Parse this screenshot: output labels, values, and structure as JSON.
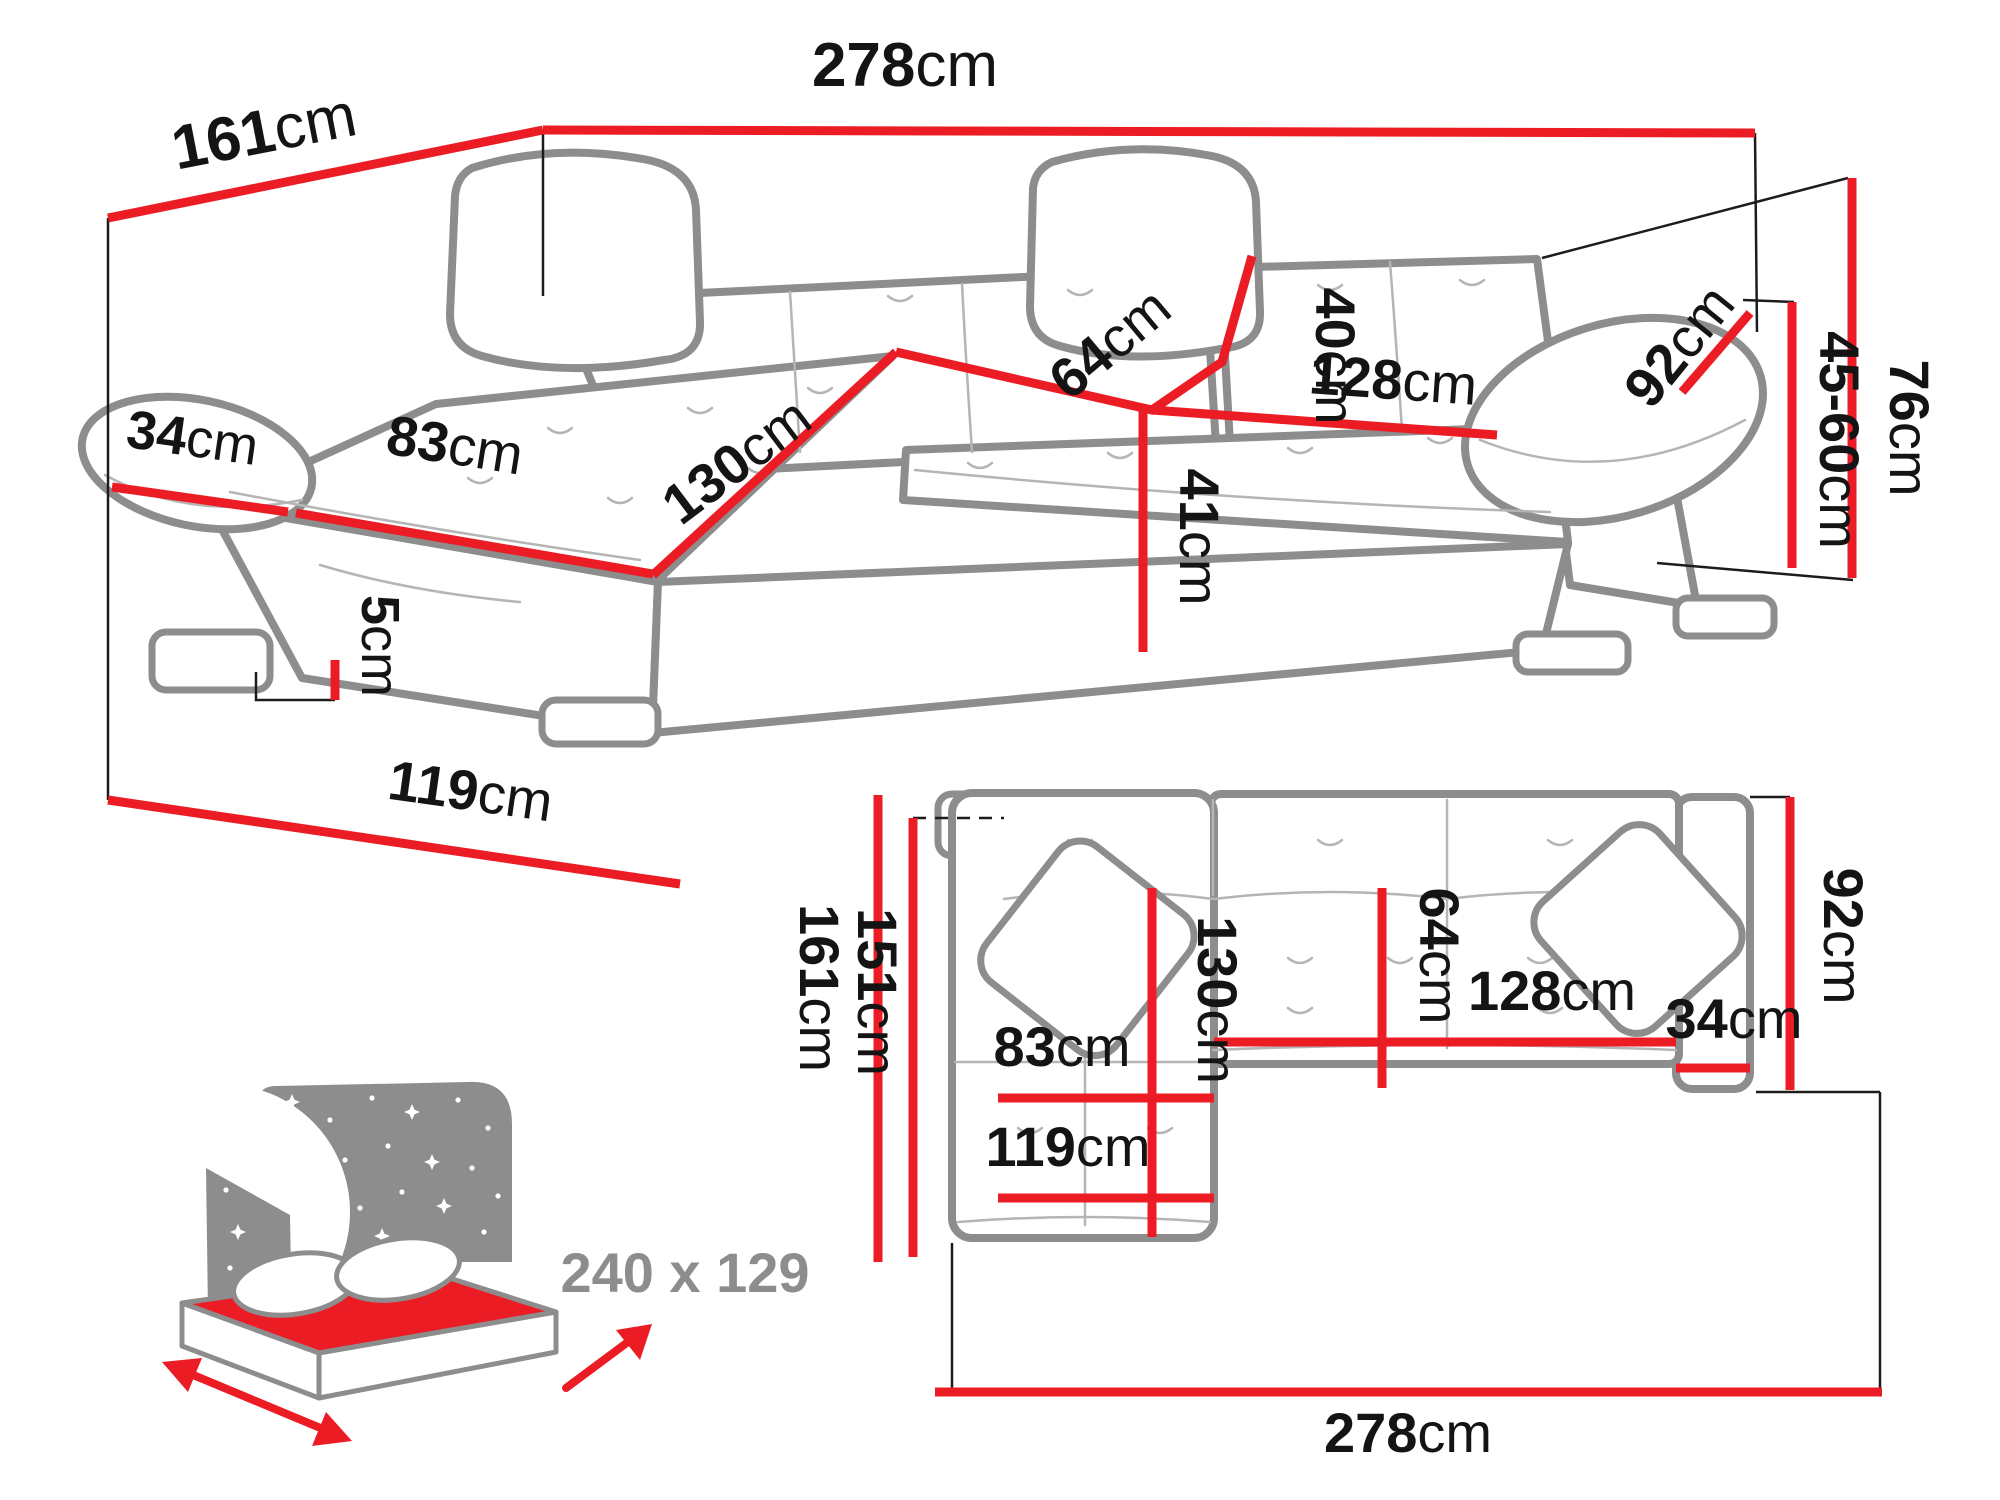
{
  "colors": {
    "dimension_red": "#ec1c24",
    "sofa_outline_gray": "#8d8d8d",
    "detail_gray": "#b5b5b5",
    "label_black": "#141414",
    "muted_gray_text": "#8d8d8d"
  },
  "perspective_view": {
    "back_width": {
      "value": "278",
      "unit": "cm"
    },
    "side_depth": {
      "value": "161",
      "unit": "cm"
    },
    "left_armrest": {
      "value": "34",
      "unit": "cm"
    },
    "chaise_seat_width": {
      "value": "83",
      "unit": "cm"
    },
    "chaise_length": {
      "value": "130",
      "unit": "cm"
    },
    "backrest_height": {
      "value": "40",
      "unit": "cm"
    },
    "seat_depth": {
      "value": "64",
      "unit": "cm"
    },
    "seat_width": {
      "value": "128",
      "unit": "cm"
    },
    "right_armrest": {
      "value": "92",
      "unit": "cm"
    },
    "seat_height": {
      "value": "41",
      "unit": "cm"
    },
    "leg_height": {
      "value": "5",
      "unit": "cm"
    },
    "front_width": {
      "value": "119",
      "unit": "cm"
    },
    "total_height": {
      "value": "76",
      "unit": "cm"
    },
    "armrest_height": {
      "value": "45-60",
      "unit": "cm"
    }
  },
  "top_view": {
    "total_depth": {
      "value": "161",
      "unit": "cm"
    },
    "inner_depth": {
      "value": "151",
      "unit": "cm"
    },
    "chaise_length": {
      "value": "130",
      "unit": "cm"
    },
    "chaise_seat_width": {
      "value": "83",
      "unit": "cm"
    },
    "front_width": {
      "value": "119",
      "unit": "cm"
    },
    "seat_depth": {
      "value": "64",
      "unit": "cm"
    },
    "seat_width": {
      "value": "128",
      "unit": "cm"
    },
    "right_armrest": {
      "value": "34",
      "unit": "cm"
    },
    "right_depth": {
      "value": "92",
      "unit": "cm"
    },
    "total_width": {
      "value": "278",
      "unit": "cm"
    }
  },
  "sleeping_area": {
    "label": "240 x 129"
  }
}
